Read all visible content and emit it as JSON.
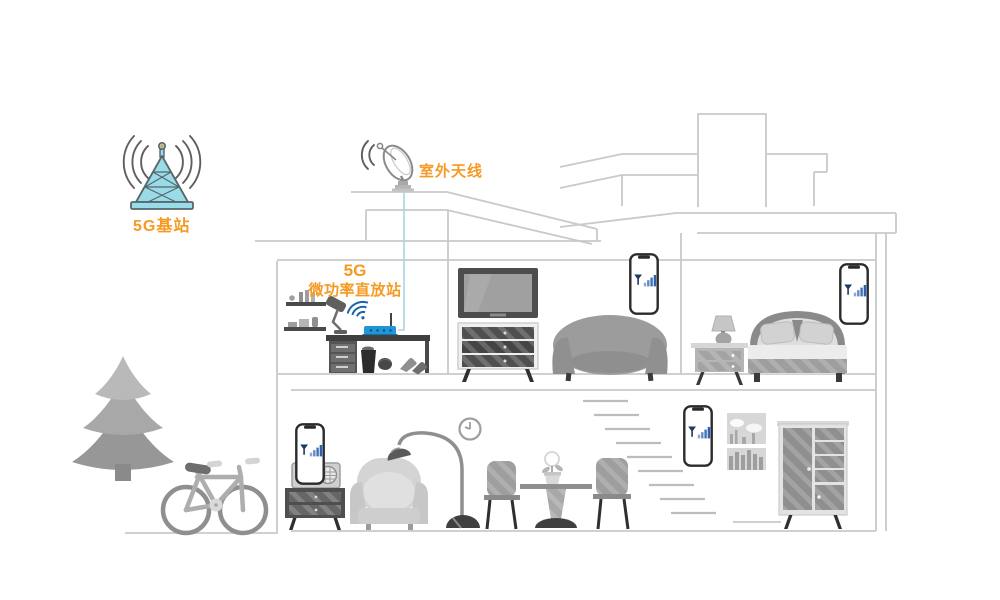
{
  "scene": {
    "labels": {
      "base_station": "5G基站",
      "outdoor_antenna": "室外天线",
      "repeater_line1": "5G",
      "repeater_line2": "微功率直放站"
    },
    "colors": {
      "label_orange": "#F59A23",
      "house_line_gray": "#C9C9C9",
      "tower_fill": "#9ADBE8",
      "tower_stroke": "#56666B",
      "router_blue": "#2196D6",
      "wifi_blue": "#1766AB",
      "signal_bar_blue": "#2E62B0",
      "cable_blue": "#ABD4EA"
    },
    "icons": [
      "5g-base-station-tower-icon",
      "radio-waves-icon",
      "satellite-dish-icon",
      "dish-waves-icon",
      "signal-cable",
      "wifi-router-icon",
      "wifi-waves-icon",
      "smartphone-signal-icon",
      "house-outline",
      "chimney",
      "stairs",
      "wall-clock",
      "picture-frame",
      "tv-icon",
      "tv-stand",
      "sofa",
      "bed",
      "nightstand",
      "table-lamp",
      "desk",
      "wall-shelves",
      "desk-lamp",
      "trash-can",
      "ball",
      "shoes",
      "radio",
      "radio-cabinet",
      "armchair",
      "floor-lamp",
      "dining-table",
      "dining-chair",
      "flower-pot",
      "wardrobe",
      "tree",
      "bicycle"
    ]
  }
}
